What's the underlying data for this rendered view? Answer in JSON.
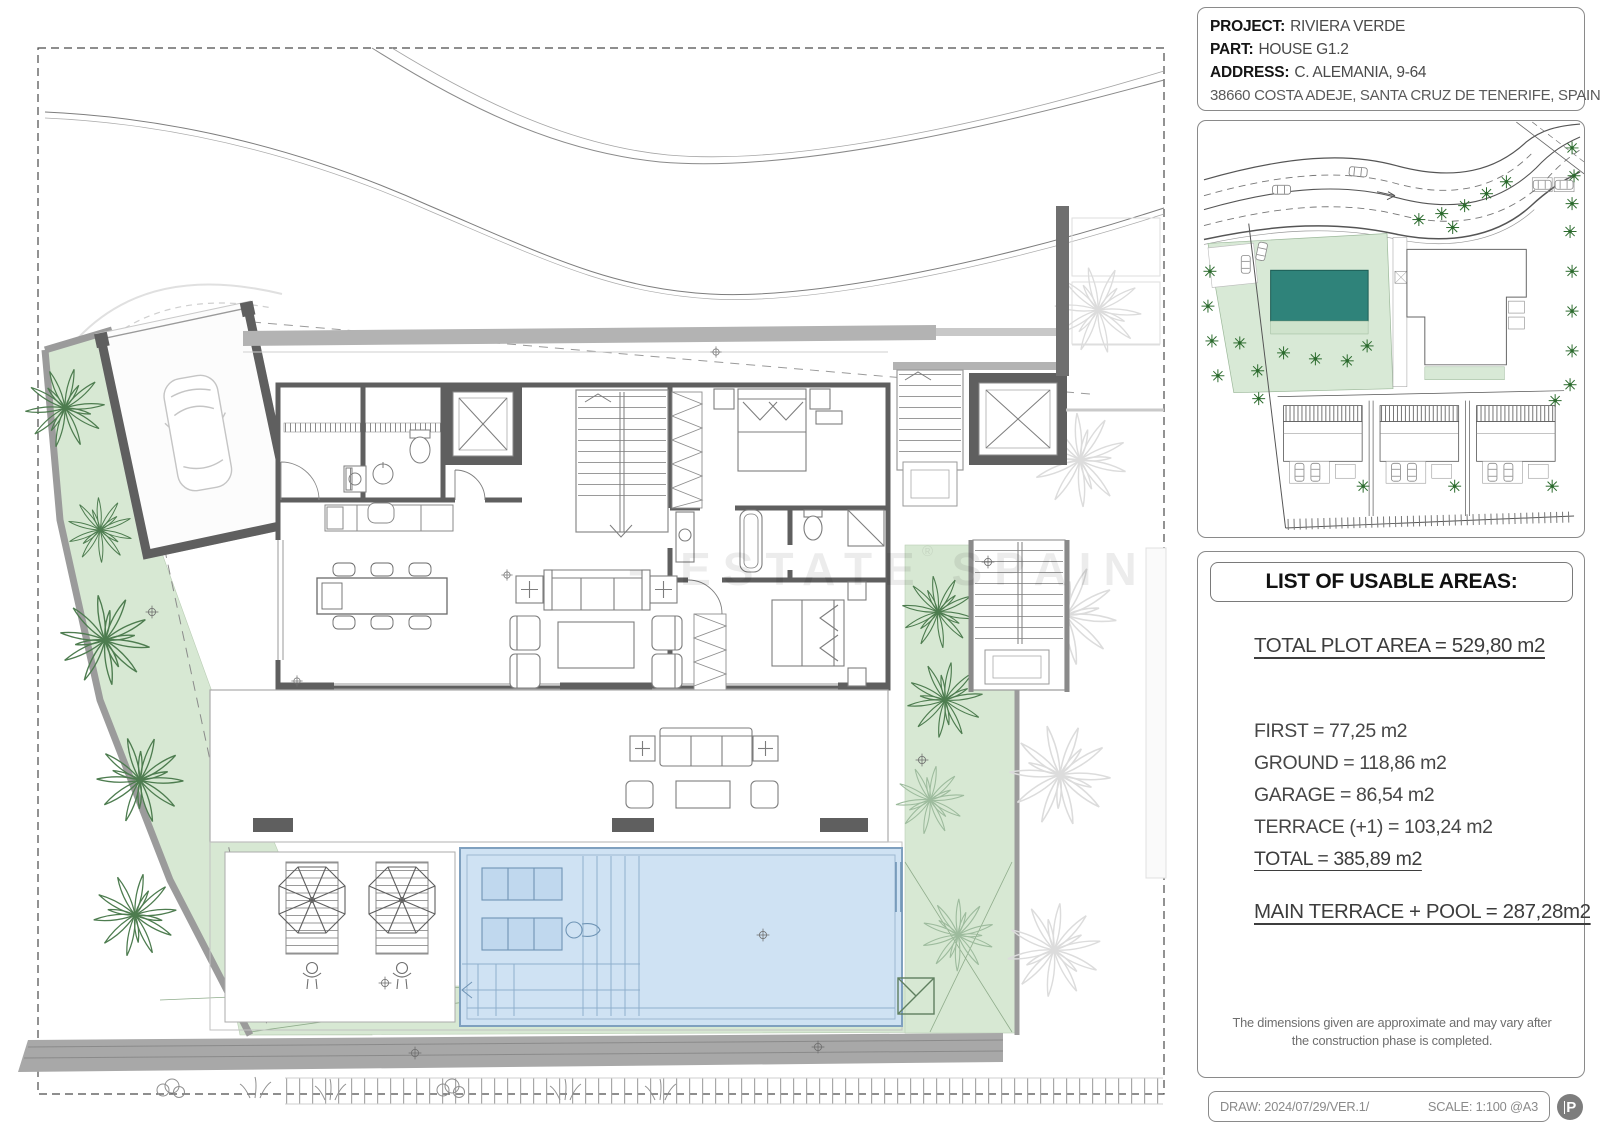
{
  "title_block": {
    "project_label": "PROJECT:",
    "project_value": "RIVIERA VERDE",
    "part_label": "PART:",
    "part_value": "HOUSE G1.2",
    "address_label": "ADDRESS:",
    "address_value": "C. ALEMANIA, 9-64",
    "address_line2": "38660 COSTA ADEJE, SANTA CRUZ DE TENERIFE, SPAIN"
  },
  "areas_panel": {
    "title": "LIST OF USABLE AREAS:",
    "total_plot": "TOTAL PLOT AREA = 529,80 m2",
    "first": "FIRST = 77,25 m2",
    "ground": "GROUND = 118,86 m2",
    "garage": "GARAGE = 86,54 m2",
    "terrace": "TERRACE (+1) = 103,24 m2",
    "total": "TOTAL = 385,89 m2",
    "main_terrace_pool": "MAIN TERRACE + POOL = 287,28m2",
    "note": "The dimensions given are approximate and may vary after the construction phase is completed."
  },
  "footer": {
    "draw": "DRAW: 2024/07/29/VER.1/",
    "scale": "SCALE: 1:100 @A3",
    "logo_letter": "P"
  },
  "watermark": {
    "text": "- ESTATE SPAIN",
    "reg": "®"
  },
  "colors": {
    "plan_green": "#d7e8d3",
    "pool_blue": "#cfe2f3",
    "map_pool_teal": "#2f837a",
    "wall_gray": "#5f5f5f",
    "roof_gray": "#b3b3b3",
    "road_gray": "#a8a8a8"
  }
}
